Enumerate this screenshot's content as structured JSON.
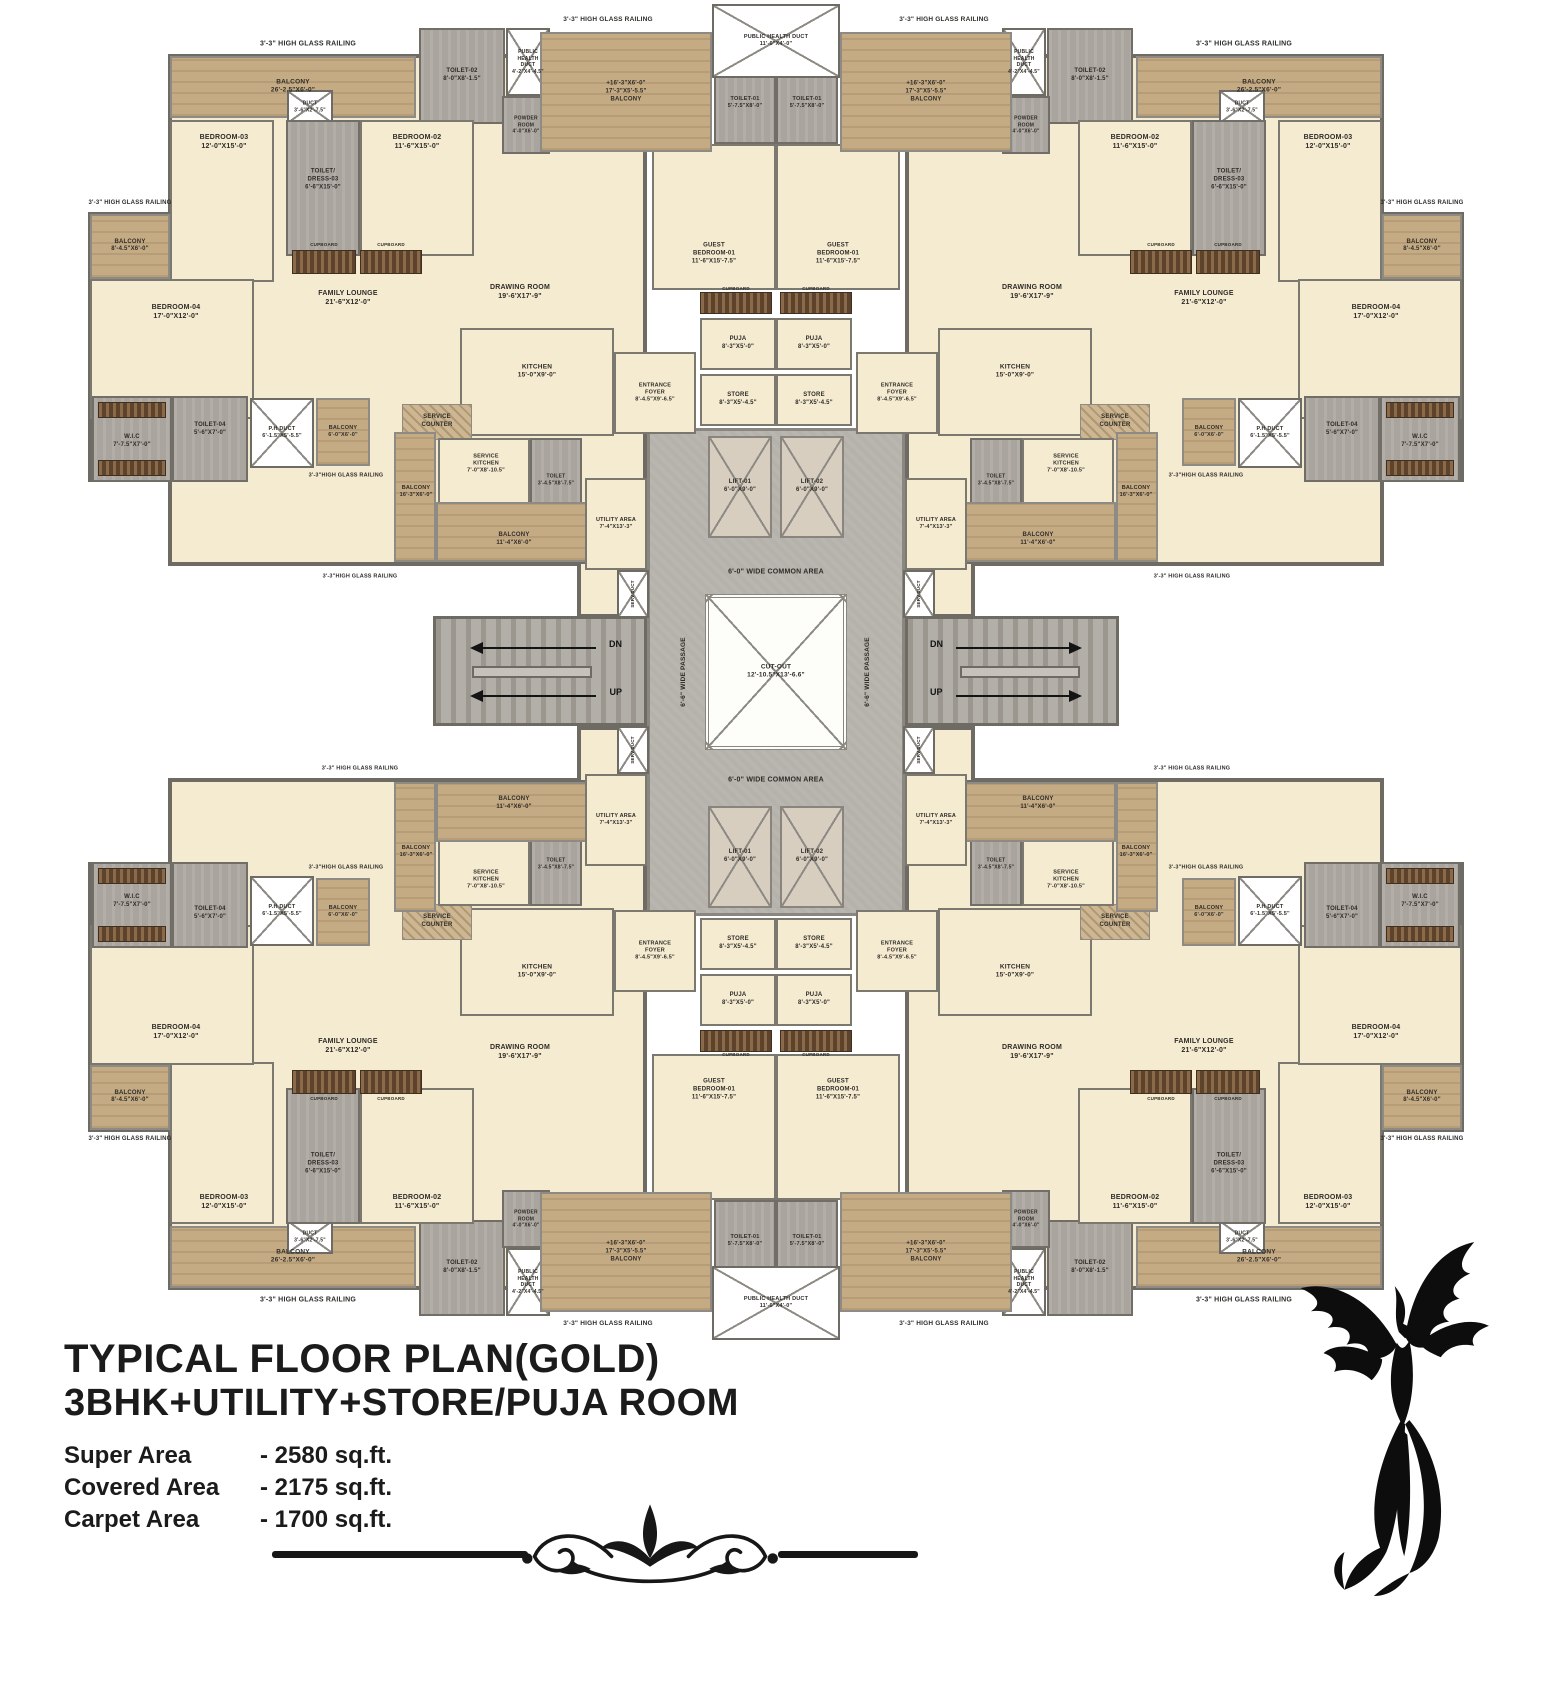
{
  "title": {
    "line1": "TYPICAL FLOOR PLAN(GOLD)",
    "line2": "3BHK+UTILITY+STORE/PUJA ROOM"
  },
  "stats": [
    {
      "label": "Super Area",
      "value": "- 2580 sq.ft."
    },
    {
      "label": "Covered Area",
      "value": "- 2175 sq.ft."
    },
    {
      "label": "Carpet Area",
      "value": "- 1700 sq.ft."
    }
  ],
  "plan": {
    "width": 1552,
    "height": 1344,
    "colors": {
      "floor": "#f5ebd1",
      "balcony_wood": "#c5ab84",
      "wet_area": "#a9a49d",
      "core_gray": "#b5b1ab",
      "wall": "#6e6b64",
      "text": "#2e2c28"
    },
    "quadrant": [
      {
        "n": "apartment-floor",
        "t": "base",
        "r": [
          168,
          54,
          479,
          512
        ]
      },
      {
        "n": "left-wing-floor",
        "t": "base",
        "r": [
          88,
          212,
          82,
          270
        ]
      },
      {
        "n": "railing-top",
        "t": "lab",
        "lp": [
          308,
          44
        ],
        "fs": 7,
        "l": "3'-3\" HIGH GLASS RAILING"
      },
      {
        "n": "balcony-main",
        "t": "balc",
        "r": [
          170,
          56,
          246,
          62
        ],
        "fs": 6.5,
        "l": "BALCONY\n26'-2.5\"X6'-0\""
      },
      {
        "n": "duct-small",
        "t": "duct",
        "r": [
          287,
          90,
          46,
          34
        ],
        "fs": 5,
        "l": "DUCT\n3'-6\"X2'-7.5\""
      },
      {
        "n": "toilet-02",
        "t": "wet",
        "r": [
          419,
          28,
          86,
          96
        ],
        "fs": 6,
        "l": "TOILET-02\n8'-0\"X8'-1.5\""
      },
      {
        "n": "public-health-duct-corner",
        "t": "duct",
        "r": [
          506,
          28,
          44,
          68
        ],
        "fs": 5,
        "l": "PUBLIC\nHEALTH\nDUCT\n4'-2\"X4'-4.5\""
      },
      {
        "n": "powder-room",
        "t": "wet",
        "r": [
          502,
          96,
          48,
          58
        ],
        "fs": 5,
        "l": "POWDER\nROOM\n4'-0\"X6'-0\""
      },
      {
        "n": "bedroom-03",
        "t": "room",
        "r": [
          170,
          120,
          104,
          162
        ],
        "lp": [
          224,
          142
        ],
        "fs": 7,
        "l": "BEDROOM-03\n12'-0\"X15'-0\""
      },
      {
        "n": "toilet-dress-03",
        "t": "wet",
        "r": [
          286,
          120,
          74,
          136
        ],
        "lp": [
          323,
          180
        ],
        "fs": 6,
        "l": "TOILET/\nDRESS-03\n6'-6\"X15'-0\""
      },
      {
        "n": "bedroom-02",
        "t": "room",
        "r": [
          360,
          120,
          114,
          136
        ],
        "lp": [
          417,
          142
        ],
        "fs": 7,
        "l": "BEDROOM-02\n11'-6\"X15'-0\""
      },
      {
        "n": "balcony-small-left",
        "t": "balc",
        "r": [
          90,
          214,
          80,
          65
        ],
        "fs": 6,
        "l": "BALCONY\n8'-4.5\"X6'-0\""
      },
      {
        "n": "railing-left",
        "t": "lab",
        "lp": [
          130,
          204
        ],
        "fs": 6,
        "l": "3'-3\" HIGH GLASS RAILING"
      },
      {
        "n": "bedroom-04",
        "t": "room",
        "r": [
          90,
          279,
          164,
          140
        ],
        "lp": [
          176,
          312
        ],
        "fs": 7,
        "l": "BEDROOM-04\n17'-0\"X12'-0\""
      },
      {
        "n": "family-lounge",
        "t": "lab",
        "lp": [
          348,
          298
        ],
        "fs": 7,
        "l": "FAMILY LOUNGE\n21'-6\"X12'-0\""
      },
      {
        "n": "cupboard-strip-a",
        "t": "cup",
        "r": [
          292,
          250,
          64,
          24
        ]
      },
      {
        "n": "cupboard-a-label",
        "t": "lab",
        "lp": [
          324,
          245
        ],
        "fs": 4.5,
        "l": "CUPBOARD"
      },
      {
        "n": "cupboard-strip-b",
        "t": "cup",
        "r": [
          360,
          250,
          62,
          24
        ]
      },
      {
        "n": "cupboard-b-label",
        "t": "lab",
        "lp": [
          391,
          245
        ],
        "fs": 4.5,
        "l": "CUPBOARD"
      },
      {
        "n": "drawing-room",
        "t": "lab",
        "lp": [
          520,
          292
        ],
        "fs": 7,
        "l": "DRAWING ROOM\n19'-6'X17'-9\""
      },
      {
        "n": "kitchen",
        "t": "room",
        "r": [
          460,
          328,
          154,
          108
        ],
        "lp": [
          537,
          372
        ],
        "fs": 6.5,
        "l": "KITCHEN\n15'-0\"X9'-0\""
      },
      {
        "n": "wic",
        "t": "wet",
        "r": [
          92,
          396,
          80,
          86
        ],
        "lp": [
          132,
          442
        ],
        "fs": 6,
        "l": "W.I.C\n7'-7.5\"X7'-0\""
      },
      {
        "n": "wic-cupboard-top",
        "t": "cup",
        "r": [
          98,
          402,
          68,
          16
        ]
      },
      {
        "n": "wic-cupboard-bottom",
        "t": "cup",
        "r": [
          98,
          460,
          68,
          16
        ]
      },
      {
        "n": "toilet-04",
        "t": "wet",
        "r": [
          172,
          396,
          76,
          86
        ],
        "lp": [
          210,
          430
        ],
        "fs": 6,
        "l": "TOILET-04\n5'-6\"X7'-0\""
      },
      {
        "n": "ph-duct-small",
        "t": "duct",
        "r": [
          250,
          398,
          64,
          70
        ],
        "fs": 5.5,
        "l": "P.H DUCT\n6'-1.5\"X5'-5.5\""
      },
      {
        "n": "balcony-6x6",
        "t": "balc",
        "r": [
          316,
          398,
          54,
          68
        ],
        "fs": 5.5,
        "l": "BALCONY\n6'-0\"X6'-0\""
      },
      {
        "n": "railing-mid",
        "t": "lab",
        "lp": [
          346,
          476
        ],
        "fs": 5.5,
        "l": "3'-3\"HIGH GLASS RAILING"
      },
      {
        "n": "service-counter",
        "t": "cnt",
        "r": [
          402,
          404,
          70,
          36
        ]
      },
      {
        "n": "service-counter-label",
        "t": "lab",
        "lp": [
          437,
          422
        ],
        "fs": 6,
        "l": "SERVICE\nCOUNTER"
      },
      {
        "n": "service-kitchen",
        "t": "room",
        "r": [
          438,
          438,
          92,
          74
        ],
        "lp": [
          486,
          464
        ],
        "fs": 5.5,
        "l": "SERVICE\nKITCHEN\n7'-0\"X8'-10.5\""
      },
      {
        "n": "service-toilet",
        "t": "wet",
        "r": [
          530,
          438,
          52,
          84
        ],
        "fs": 5,
        "l": "TOILET\n3'-4.5\"X8'-7.5\""
      },
      {
        "n": "balcony-16",
        "t": "balc",
        "r": [
          394,
          432,
          42,
          130
        ],
        "lp": [
          416,
          492
        ],
        "fs": 5.5,
        "l": "BALCONY\n16'-3\"X6'-0\""
      },
      {
        "n": "balcony-11",
        "t": "balc",
        "r": [
          436,
          502,
          156,
          60
        ],
        "lp": [
          514,
          540
        ],
        "fs": 6,
        "l": "BALCONY\n11'-4\"X6'-0\""
      },
      {
        "n": "utility-area",
        "t": "room",
        "r": [
          585,
          478,
          62,
          92
        ],
        "fs": 5.5,
        "l": "UTILITY AREA\n7'-4\"X13'-3\""
      },
      {
        "n": "entrance-foyer",
        "t": "room",
        "r": [
          614,
          352,
          82,
          82
        ],
        "fs": 5.5,
        "l": "ENTRANCE\nFOYER\n8'-4.5\"X9'-6.5\""
      },
      {
        "n": "guest-bedroom-01",
        "t": "room",
        "r": [
          652,
          144,
          124,
          146
        ],
        "lp": [
          714,
          254
        ],
        "fs": 6,
        "l": "GUEST\nBEDROOM-01\n11'-6\"X15'-7.5\""
      },
      {
        "n": "guest-cupboard",
        "t": "cup",
        "r": [
          700,
          292,
          72,
          22
        ]
      },
      {
        "n": "guest-cupboard-label",
        "t": "lab",
        "lp": [
          736,
          289
        ],
        "fs": 4.5,
        "l": "CUPBOARD"
      },
      {
        "n": "puja",
        "t": "room",
        "r": [
          700,
          318,
          76,
          52
        ],
        "fs": 6,
        "l": "PUJA\n8'-3\"X5'-0\""
      },
      {
        "n": "store",
        "t": "room",
        "r": [
          700,
          374,
          76,
          52
        ],
        "fs": 6,
        "l": "STORE\n8'-3\"X5'-4.5\""
      },
      {
        "n": "toilet-01",
        "t": "wet",
        "r": [
          714,
          62,
          62,
          82
        ],
        "fs": 5.5,
        "l": "TOILET-01\n5'-7.5\"X8'-0\""
      },
      {
        "n": "balcony-center",
        "t": "balc",
        "r": [
          540,
          32,
          172,
          120
        ],
        "fs": 6,
        "l": "+16'-3\"X6'-0\"\n17'-3\"X5'-5.5\"\nBALCONY"
      },
      {
        "n": "railing-center",
        "t": "lab",
        "lp": [
          608,
          20
        ],
        "fs": 6.5,
        "l": "3'-3\" HIGH GLASS RAILING"
      }
    ],
    "middle": [
      {
        "n": "stair-landing-lt",
        "t": "base",
        "r": [
          577,
          560,
          70,
          58
        ]
      },
      {
        "n": "stair-landing-lb",
        "t": "base",
        "r": [
          577,
          726,
          70,
          58
        ]
      },
      {
        "n": "stair-landing-rt",
        "t": "base",
        "r": [
          905,
          560,
          70,
          58
        ]
      },
      {
        "n": "stair-landing-rb",
        "t": "base",
        "r": [
          905,
          726,
          70,
          58
        ]
      },
      {
        "n": "central-core",
        "t": "core",
        "r": [
          647,
          428,
          258,
          488
        ]
      },
      {
        "n": "stairs-left",
        "t": "stair",
        "r": [
          433,
          616,
          214,
          110
        ]
      },
      {
        "n": "stairs-right",
        "t": "stair",
        "r": [
          905,
          616,
          214,
          110
        ]
      },
      {
        "n": "stair-rail-left",
        "t": "railbar",
        "r": [
          472,
          666,
          120,
          12
        ]
      },
      {
        "n": "stair-rail-right",
        "t": "railbar",
        "r": [
          960,
          666,
          120,
          12
        ]
      },
      {
        "n": "serv-duct-tl",
        "t": "duct",
        "r": [
          617,
          570,
          32,
          48
        ],
        "fs": 4.5,
        "rot": -90,
        "l": "SERV.DUCT"
      },
      {
        "n": "serv-duct-bl",
        "t": "duct",
        "r": [
          617,
          726,
          32,
          48
        ],
        "fs": 4.5,
        "rot": -90,
        "l": "SERV.DUCT"
      },
      {
        "n": "serv-duct-tr",
        "t": "duct",
        "r": [
          903,
          570,
          32,
          48
        ],
        "fs": 4.5,
        "rot": -90,
        "l": "SERV.DUCT"
      },
      {
        "n": "serv-duct-br",
        "t": "duct",
        "r": [
          903,
          726,
          32,
          48
        ],
        "fs": 4.5,
        "rot": -90,
        "l": "SERV.DUCT"
      },
      {
        "n": "cut-out",
        "t": "cutout",
        "r": [
          705,
          594,
          142,
          156
        ],
        "fs": 6.5,
        "l": "CUT-OUT\n12'-10.5\"X13'-6.6\""
      },
      {
        "n": "common-area-top",
        "t": "lab",
        "lp": [
          776,
          572
        ],
        "fs": 7,
        "l": "6'-0\" WIDE COMMON AREA"
      },
      {
        "n": "common-area-bottom",
        "t": "lab",
        "lp": [
          776,
          780
        ],
        "fs": 7,
        "l": "6'-0\" WIDE COMMON AREA"
      },
      {
        "n": "passage-left",
        "t": "lab",
        "lp": [
          684,
          672
        ],
        "fs": 6.5,
        "rot": -90,
        "l": "6'-6\" WIDE PASSAGE"
      },
      {
        "n": "passage-right",
        "t": "lab",
        "lp": [
          868,
          672
        ],
        "fs": 6.5,
        "rot": -90,
        "l": "6'-6\" WIDE PASSAGE"
      },
      {
        "n": "railing-stair-lt",
        "t": "lab",
        "lp": [
          360,
          577
        ],
        "fs": 5.5,
        "l": "3'-3\"HIGH GLASS RAILING"
      },
      {
        "n": "railing-stair-lb",
        "t": "lab",
        "lp": [
          360,
          769
        ],
        "fs": 5.5,
        "l": "3'-3\" HIGH GLASS RAILING"
      },
      {
        "n": "railing-stair-rt",
        "t": "lab",
        "lp": [
          1192,
          577
        ],
        "fs": 5.5,
        "l": "3'-3\" HIGH GLASS RAILING"
      },
      {
        "n": "railing-stair-rb",
        "t": "lab",
        "lp": [
          1192,
          769
        ],
        "fs": 5.5,
        "l": "3'-3\" HIGH GLASS RAILING"
      },
      {
        "n": "arrow-dn-left",
        "t": "arrow",
        "r": [
          470,
          642,
          126,
          12
        ],
        "dir": "left",
        "l": "DN"
      },
      {
        "n": "arrow-up-left",
        "t": "arrow",
        "r": [
          470,
          690,
          126,
          12
        ],
        "dir": "left",
        "l": "UP"
      },
      {
        "n": "arrow-dn-right",
        "t": "arrow",
        "r": [
          956,
          642,
          126,
          12
        ],
        "dir": "right",
        "l": "DN"
      },
      {
        "n": "arrow-up-right",
        "t": "arrow",
        "r": [
          956,
          690,
          126,
          12
        ],
        "dir": "right",
        "l": "UP"
      }
    ],
    "pairs": [
      {
        "n": "lift-01-top",
        "t": "lift",
        "r": [
          708,
          436,
          64,
          102
        ],
        "fs": 6,
        "l": "LIFT-01\n6'-0\"X9'-0\""
      },
      {
        "n": "lift-02-top",
        "t": "lift",
        "r": [
          780,
          436,
          64,
          102
        ],
        "fs": 6,
        "l": "LIFT-02\n6'-0\"X9'-0\""
      },
      {
        "n": "lift-01-bottom",
        "t": "lift",
        "r": [
          708,
          806,
          64,
          102
        ],
        "fs": 6,
        "l": "LIFT-01\n6'-0\"X9'-0\""
      },
      {
        "n": "lift-02-bottom",
        "t": "lift",
        "r": [
          780,
          806,
          64,
          102
        ],
        "fs": 6,
        "l": "LIFT-02\n6'-0\"X9'-0\""
      },
      {
        "n": "public-health-duct-top",
        "t": "duct",
        "r": [
          712,
          4,
          128,
          74
        ],
        "fs": 5.5,
        "l": "PUBLIC HEALTH DUCT\n11'-6\"X4'-0\""
      },
      {
        "n": "public-health-duct-bottom",
        "t": "duct",
        "r": [
          712,
          1266,
          128,
          74
        ],
        "fs": 5.5,
        "l": "PUBLIC HEALTH DUCT\n11'-6\"X4'-0\""
      }
    ]
  }
}
